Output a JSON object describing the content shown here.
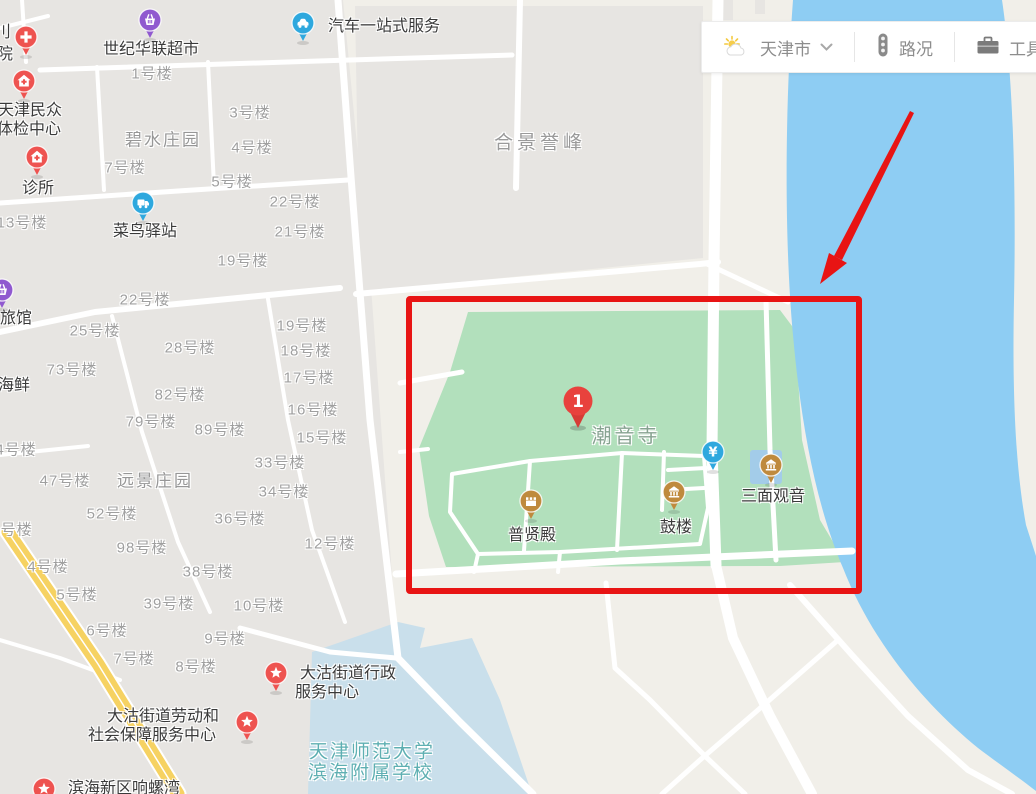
{
  "toolbar": {
    "city": "天津市",
    "traffic": "路况",
    "tools": "工具箱",
    "icons": [
      "weather-icon",
      "chevron-down-icon",
      "traffic-light-icon",
      "toolbox-icon"
    ]
  },
  "colors": {
    "highlight": "#e81414",
    "park": "#b2e0bc",
    "river": "#8ecdf3",
    "school_zone": "#c9dfeb",
    "yellow_road": "#f6d262",
    "pin_red": "#ee5350",
    "pin_blue": "#2ea8de",
    "pin_purple": "#9059cf",
    "pin_tan": "#bf8a3d",
    "result_marker_red": "#e8423d"
  },
  "annotation": {
    "rect": {
      "x": 406,
      "y": 296,
      "w": 444,
      "h": 286
    },
    "arrow": {
      "shaft": "910,111 914,113 842,260 834,256",
      "head": "829,253 847,263 820,284"
    }
  },
  "map": {
    "labels": [
      {
        "cls": "poi",
        "text": "世纪华联超市",
        "x": 151,
        "y": 47
      },
      {
        "cls": "poi",
        "text": "汽车一站式服务",
        "x": 384,
        "y": 24
      },
      {
        "cls": "poi",
        "text": "天津民众",
        "x": 30,
        "y": 108
      },
      {
        "cls": "poi",
        "text": "体检中心",
        "x": 29,
        "y": 127
      },
      {
        "cls": "poi",
        "text": "诊所",
        "x": 38,
        "y": 186
      },
      {
        "cls": "poi",
        "text": "菜鸟驿站",
        "x": 145,
        "y": 229
      },
      {
        "cls": "poi",
        "text": "旅馆",
        "x": 16,
        "y": 316
      },
      {
        "cls": "poi",
        "text": "海鲜",
        "x": 14,
        "y": 383
      },
      {
        "cls": "poi",
        "text": "刂",
        "x": 3,
        "y": 30
      },
      {
        "cls": "poi",
        "text": "院",
        "x": 5,
        "y": 52
      },
      {
        "cls": "area",
        "text": "碧水庄园",
        "x": 163,
        "y": 138
      },
      {
        "cls": "area-big",
        "text": "合景誉峰",
        "x": 540,
        "y": 141
      },
      {
        "cls": "area",
        "text": "远景庄园",
        "x": 155,
        "y": 479
      },
      {
        "cls": "park-name",
        "text": "潮音寺",
        "x": 626,
        "y": 434
      },
      {
        "cls": "poi",
        "text": "普贤殿",
        "x": 532,
        "y": 533
      },
      {
        "cls": "poi",
        "text": "鼓楼",
        "x": 676,
        "y": 525
      },
      {
        "cls": "poi",
        "text": "三面观音",
        "x": 773,
        "y": 494
      },
      {
        "cls": "poi",
        "text": "大沽街道行政",
        "x": 348,
        "y": 671
      },
      {
        "cls": "poi",
        "text": "服务中心",
        "x": 327,
        "y": 690
      },
      {
        "cls": "poi",
        "text": "大沽街道劳动和",
        "x": 163,
        "y": 714
      },
      {
        "cls": "poi",
        "text": "社会保障服务中心",
        "x": 152,
        "y": 733
      },
      {
        "cls": "school",
        "text": "天津师范大学",
        "x": 372,
        "y": 750
      },
      {
        "cls": "school",
        "text": "滨海附属学校",
        "x": 371,
        "y": 771
      },
      {
        "cls": "poi",
        "text": "滨海新区响螺湾",
        "x": 124,
        "y": 786
      }
    ],
    "buildings": [
      {
        "text": "1号楼",
        "x": 152,
        "y": 73
      },
      {
        "text": "3号楼",
        "x": 250,
        "y": 112
      },
      {
        "text": "4号楼",
        "x": 252,
        "y": 147
      },
      {
        "text": "7号楼",
        "x": 125,
        "y": 167
      },
      {
        "text": "5号楼",
        "x": 232,
        "y": 181
      },
      {
        "text": "22号楼",
        "x": 295,
        "y": 201
      },
      {
        "text": "21号楼",
        "x": 300,
        "y": 231
      },
      {
        "text": "19号楼",
        "x": 243,
        "y": 260
      },
      {
        "text": "13号楼",
        "x": 22,
        "y": 222
      },
      {
        "text": "22号楼",
        "x": 145,
        "y": 299
      },
      {
        "text": "25号楼",
        "x": 95,
        "y": 330
      },
      {
        "text": "19号楼",
        "x": 302,
        "y": 325
      },
      {
        "text": "28号楼",
        "x": 190,
        "y": 347
      },
      {
        "text": "18号楼",
        "x": 306,
        "y": 350
      },
      {
        "text": "73号楼",
        "x": 72,
        "y": 369
      },
      {
        "text": "17号楼",
        "x": 309,
        "y": 377
      },
      {
        "text": "82号楼",
        "x": 180,
        "y": 394
      },
      {
        "text": "16号楼",
        "x": 313,
        "y": 409
      },
      {
        "text": "79号楼",
        "x": 151,
        "y": 421
      },
      {
        "text": "89号楼",
        "x": 220,
        "y": 429
      },
      {
        "text": "15号楼",
        "x": 322,
        "y": 437
      },
      {
        "text": "4号楼",
        "x": 16,
        "y": 449
      },
      {
        "text": "33号楼",
        "x": 280,
        "y": 462
      },
      {
        "text": "47号楼",
        "x": 65,
        "y": 480
      },
      {
        "text": "34号楼",
        "x": 284,
        "y": 491
      },
      {
        "text": "52号楼",
        "x": 112,
        "y": 513
      },
      {
        "text": "36号楼",
        "x": 240,
        "y": 518
      },
      {
        "text": "3号楼",
        "x": 12,
        "y": 529
      },
      {
        "text": "98号楼",
        "x": 142,
        "y": 547
      },
      {
        "text": "12号楼",
        "x": 330,
        "y": 543
      },
      {
        "text": "4号楼",
        "x": 48,
        "y": 566
      },
      {
        "text": "38号楼",
        "x": 208,
        "y": 571
      },
      {
        "text": "5号楼",
        "x": 77,
        "y": 594
      },
      {
        "text": "39号楼",
        "x": 169,
        "y": 603
      },
      {
        "text": "10号楼",
        "x": 259,
        "y": 605
      },
      {
        "text": "6号楼",
        "x": 107,
        "y": 630
      },
      {
        "text": "9号楼",
        "x": 225,
        "y": 638
      },
      {
        "text": "7号楼",
        "x": 134,
        "y": 658
      },
      {
        "text": "8号楼",
        "x": 196,
        "y": 666
      }
    ],
    "markers": [
      {
        "name": "hospital-pin",
        "icon": "cross",
        "pin": "red",
        "x": 26,
        "y": 37
      },
      {
        "name": "checkup-center-pin",
        "icon": "house",
        "pin": "red",
        "x": 24,
        "y": 81
      },
      {
        "name": "clinic-pin",
        "icon": "house",
        "pin": "red",
        "x": 37,
        "y": 157
      },
      {
        "name": "supermarket-pin",
        "icon": "basket",
        "pin": "purple",
        "x": 150,
        "y": 20
      },
      {
        "name": "car-service-pin",
        "icon": "car",
        "pin": "blue",
        "x": 303,
        "y": 23
      },
      {
        "name": "cainiao-station-pin",
        "icon": "truck",
        "pin": "blue",
        "x": 143,
        "y": 203
      },
      {
        "name": "hotel-pin",
        "icon": "basket",
        "pin": "purple",
        "x": 2,
        "y": 290
      },
      {
        "name": "sanmian-guanyin-pin",
        "icon": "temple",
        "pin": "tan",
        "x": 771,
        "y": 465
      },
      {
        "name": "gulou-pin",
        "icon": "temple",
        "pin": "tan",
        "x": 674,
        "y": 492
      },
      {
        "name": "puxiandian-pin",
        "icon": "palace",
        "pin": "tan",
        "x": 531,
        "y": 501
      },
      {
        "name": "ticket-pin",
        "icon": "yuan",
        "pin": "blue",
        "x": 713,
        "y": 452
      },
      {
        "name": "admin-center-pin",
        "icon": "star",
        "pin": "red",
        "x": 276,
        "y": 673
      },
      {
        "name": "labor-center-pin",
        "icon": "star",
        "pin": "red",
        "x": 247,
        "y": 722
      },
      {
        "name": "xiangluowan-pin",
        "icon": "star",
        "pin": "red",
        "x": 44,
        "y": 789
      },
      {
        "name": "chaoyin-temple-result-marker",
        "icon": "numbered",
        "label": "1",
        "x": 578,
        "y": 401
      }
    ]
  }
}
